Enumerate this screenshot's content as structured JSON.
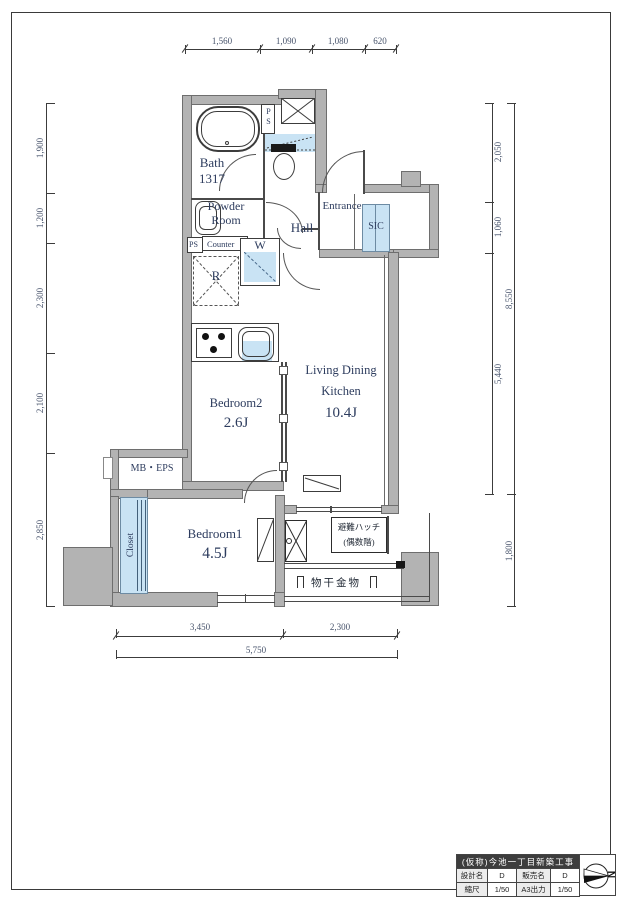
{
  "plan": {
    "rooms": {
      "bath": {
        "name": "Bath",
        "code": "1317"
      },
      "powder": {
        "line1": "Powder",
        "line2": "Room"
      },
      "hall": "Hall",
      "entrance": "Entrance",
      "sic": "SIC",
      "ldk": {
        "line1": "Living Dining",
        "line2": "Kitchen",
        "size": "10.4J"
      },
      "bedroom2": {
        "name": "Bedroom2",
        "size": "2.6J"
      },
      "bedroom1": {
        "name": "Bedroom1",
        "size": "4.5J"
      },
      "closet": "Closet",
      "mb_eps": "MB・EPS"
    },
    "fixtures": {
      "ps_shaft": "PS",
      "ps_small": "PS",
      "counter": "Counter",
      "washer": "W",
      "fridge": "R"
    },
    "balcony": {
      "hatch_line1": "避難ハッチ",
      "hatch_line2": "(偶数階)",
      "laundry": "物干金物"
    }
  },
  "dims": {
    "top": [
      "1,560",
      "1,090",
      "1,080",
      "620"
    ],
    "left": [
      "1,900",
      "1,200",
      "2,300",
      "2,100",
      "2,850"
    ],
    "right_inner": [
      "2,050",
      "1,060",
      "5,440"
    ],
    "right_outer": [
      "8,550",
      "1,800"
    ],
    "bottom": [
      "3,450",
      "2,300"
    ],
    "bottom_total": "5,750"
  },
  "title_block": {
    "title": "(仮称)今池一丁目新築工事",
    "rows": [
      [
        "設計名",
        "D",
        "販売名",
        "D"
      ],
      [
        "縮尺",
        "1/50",
        "A3出力",
        "1/50"
      ]
    ],
    "north": "N"
  },
  "colors": {
    "wall": "#b3b3b3",
    "fixture_blue": "#c9e3f4",
    "label": "#2d3c5e"
  }
}
